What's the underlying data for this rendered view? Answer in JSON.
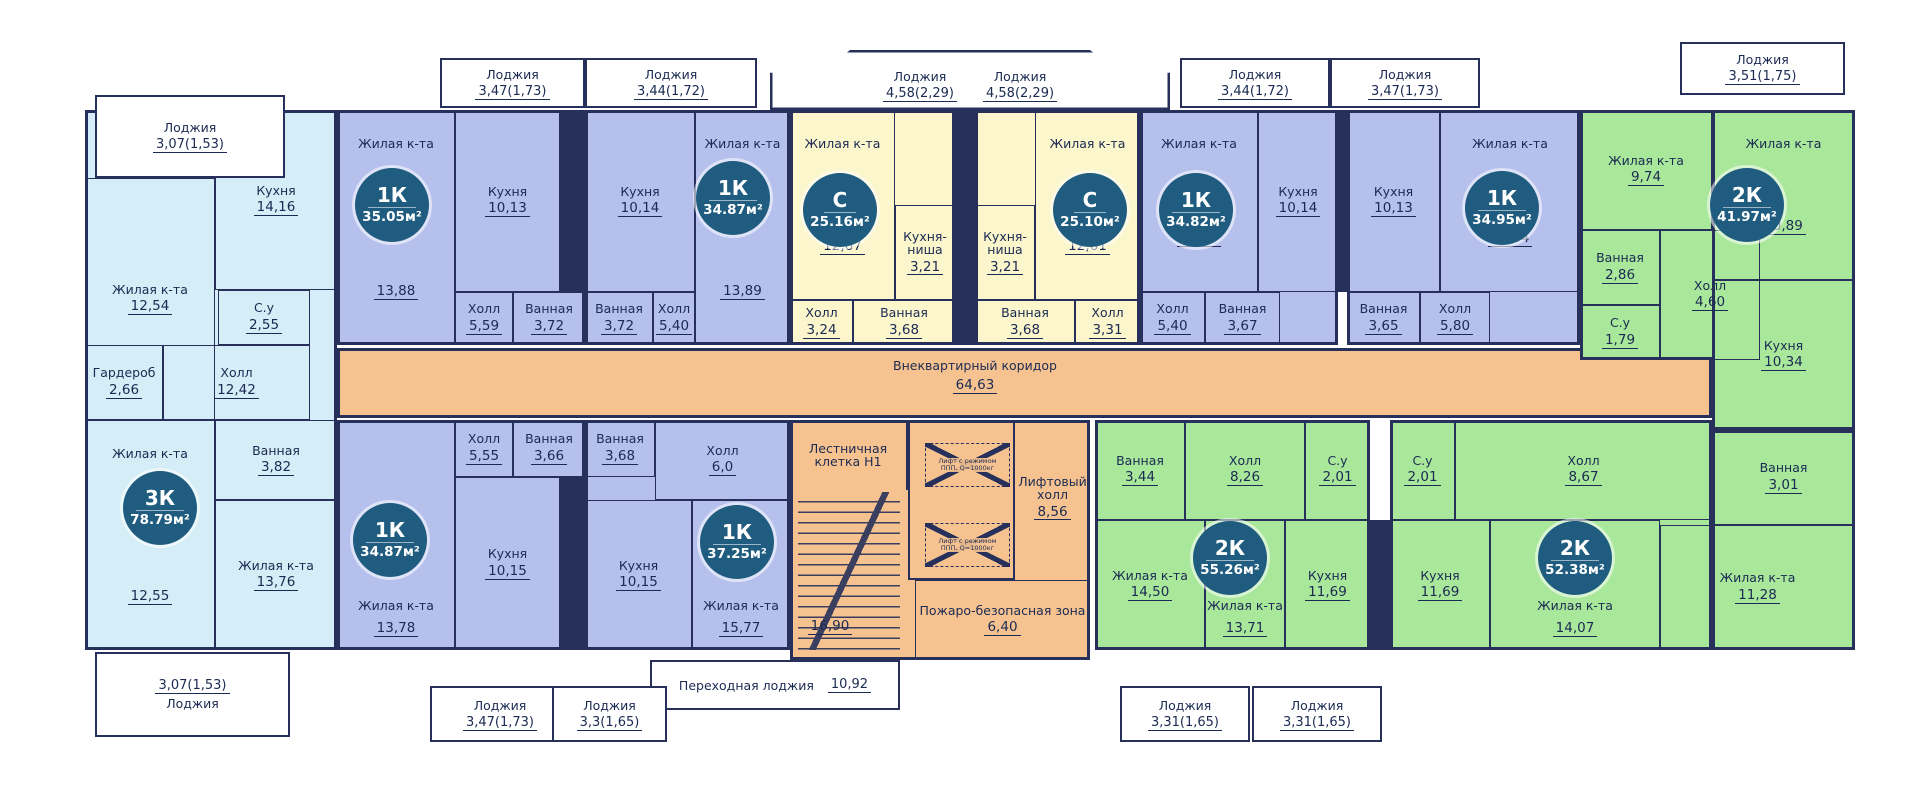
{
  "colors": {
    "apartment_3k": "#d5edf6",
    "apartment_1k": "#b5c0ed",
    "apartment_studio": "#fbf6cc",
    "apartment_2k": "#a9e79b",
    "common_area": "#f6c390",
    "badge": "#1f5c7f",
    "line": "#26305a"
  },
  "corridor": {
    "name": "Внеквартирный коридор",
    "area": "64,63"
  },
  "core": {
    "stairs_name": "Лестничная клетка Н1",
    "stairs_area": "16,90",
    "lift_hall_name": "Лифтовый холл",
    "lift_hall_area": "8,56",
    "lift_cabin_line1": "Лифт с режимом",
    "lift_cabin_line2": "ППП, Q=1000кг",
    "fire_zone_name": "Пожаро-безопасная зона",
    "fire_zone_area": "6,40",
    "transfer_loggia_name": "Переходная лоджия",
    "transfer_loggia_area": "10,92"
  },
  "apartments": [
    {
      "badge_type": "3К",
      "badge_area": "78.79м²",
      "rooms": [
        {
          "name": "Жилая к-та",
          "area": "12,54"
        },
        {
          "name": "Кухня",
          "area": "14,16"
        },
        {
          "name": "С.у",
          "area": "2,55"
        },
        {
          "name": "Гардероб",
          "area": "2,66"
        },
        {
          "name": "Холл",
          "area": "12,42"
        },
        {
          "name": "Ванная",
          "area": "3,82"
        },
        {
          "name": "Жилая к-та",
          "area": "12,55"
        },
        {
          "name": "Жилая к-та",
          "area": "13,76"
        }
      ],
      "loggias": [
        {
          "name": "Лоджия",
          "area": "3,07(1,53)"
        },
        {
          "name": "Лоджия",
          "area": "3,07(1,53)"
        }
      ]
    },
    {
      "badge_type": "1К",
      "badge_area": "35.05м²",
      "rooms": [
        {
          "name": "Жилая к-та",
          "area": "13,88"
        },
        {
          "name": "Кухня",
          "area": "10,13"
        },
        {
          "name": "Холл",
          "area": "5,59"
        },
        {
          "name": "Ванная",
          "area": "3,72"
        }
      ],
      "loggias": [
        {
          "name": "Лоджия",
          "area": "3,47(1,73)"
        }
      ]
    },
    {
      "badge_type": "1К",
      "badge_area": "34.87м²",
      "rooms": [
        {
          "name": "Кухня",
          "area": "10,14"
        },
        {
          "name": "Жилая к-та",
          "area": "13,89"
        },
        {
          "name": "Ванная",
          "area": "3,72"
        },
        {
          "name": "Холл",
          "area": "5,40"
        }
      ],
      "loggias": [
        {
          "name": "Лоджия",
          "area": "3,44(1,72)"
        }
      ]
    },
    {
      "badge_type": "С",
      "badge_area": "25.16м²",
      "rooms": [
        {
          "name": "Жилая к-та",
          "area": "12,67"
        },
        {
          "name": "Кухня-ниша",
          "area": "3,21"
        },
        {
          "name": "Холл",
          "area": "3,24"
        },
        {
          "name": "Ванная",
          "area": "3,68"
        }
      ],
      "loggias": [
        {
          "name": "Лоджия",
          "area": "4,58(2,29)"
        }
      ]
    },
    {
      "badge_type": "С",
      "badge_area": "25.10м²",
      "rooms": [
        {
          "name": "Кухня-ниша",
          "area": "3,21"
        },
        {
          "name": "Жилая к-та",
          "area": "12,61"
        },
        {
          "name": "Ванная",
          "area": "3,68"
        },
        {
          "name": "Холл",
          "area": "3,31"
        }
      ],
      "loggias": [
        {
          "name": "Лоджия",
          "area": "4,58(2,29)"
        }
      ]
    },
    {
      "badge_type": "1К",
      "badge_area": "34.82м²",
      "rooms": [
        {
          "name": "Жилая к-та",
          "area": "13,89"
        },
        {
          "name": "Кухня",
          "area": "10,14"
        },
        {
          "name": "Холл",
          "area": "5,40"
        },
        {
          "name": "Ванная",
          "area": "3,67"
        }
      ],
      "loggias": [
        {
          "name": "Лоджия",
          "area": "3,44(1,72)"
        }
      ]
    },
    {
      "badge_type": "1К",
      "badge_area": "34.95м²",
      "rooms": [
        {
          "name": "Кухня",
          "area": "10,13"
        },
        {
          "name": "Жилая к-та",
          "area": "13,64"
        },
        {
          "name": "Ванная",
          "area": "3,65"
        },
        {
          "name": "Холл",
          "area": "5,80"
        }
      ],
      "loggias": [
        {
          "name": "Лоджия",
          "area": "3,47(1,73)"
        }
      ]
    },
    {
      "badge_type": "2К",
      "badge_area": "41.97м²",
      "rooms": [
        {
          "name": "Жилая к-та",
          "area": "9,74"
        },
        {
          "name": "Ванная",
          "area": "2,86"
        },
        {
          "name": "Холл",
          "area": "4,60"
        },
        {
          "name": "С.у",
          "area": "1,79"
        },
        {
          "name": "Жилая к-та",
          "area": "10,89"
        },
        {
          "name": "Кухня",
          "area": "10,34"
        }
      ],
      "loggias": [
        {
          "name": "Лоджия",
          "area": "3,51(1,75)"
        }
      ]
    },
    {
      "badge_type": "1К",
      "badge_area": "34.87м²",
      "rooms": [
        {
          "name": "Жилая к-та",
          "area": "13,78"
        },
        {
          "name": "Холл",
          "area": "5,55"
        },
        {
          "name": "Ванная",
          "area": "3,66"
        },
        {
          "name": "Кухня",
          "area": "10,15"
        }
      ],
      "loggias": [
        {
          "name": "Лоджия",
          "area": "3,47(1,73)"
        }
      ]
    },
    {
      "badge_type": "1К",
      "badge_area": "37.25м²",
      "rooms": [
        {
          "name": "Ванная",
          "area": "3,68"
        },
        {
          "name": "Холл",
          "area": "6,0"
        },
        {
          "name": "Кухня",
          "area": "10,15"
        },
        {
          "name": "Жилая к-та",
          "area": "15,77"
        }
      ],
      "loggias": [
        {
          "name": "Лоджия",
          "area": "3,3(1,65)"
        }
      ]
    },
    {
      "badge_type": "2К",
      "badge_area": "55.26м²",
      "rooms": [
        {
          "name": "Ванная",
          "area": "3,44"
        },
        {
          "name": "Холл",
          "area": "8,26"
        },
        {
          "name": "С.у",
          "area": "2,01"
        },
        {
          "name": "Жилая к-та",
          "area": "14,50"
        },
        {
          "name": "Жилая к-та",
          "area": "13,71"
        },
        {
          "name": "Кухня",
          "area": "11,69"
        }
      ],
      "loggias": [
        {
          "name": "Лоджия",
          "area": "3,31(1,65)"
        }
      ]
    },
    {
      "badge_type": "2К",
      "badge_area": "52.38м²",
      "rooms": [
        {
          "name": "С.у",
          "area": "2,01"
        },
        {
          "name": "Холл",
          "area": "8,67"
        },
        {
          "name": "Ванная",
          "area": "3,01"
        },
        {
          "name": "Кухня",
          "area": "11,69"
        },
        {
          "name": "Жилая к-та",
          "area": "14,07"
        },
        {
          "name": "Жилая к-та",
          "area": "11,28"
        }
      ],
      "loggias": [
        {
          "name": "Лоджия",
          "area": "3,31(1,65)"
        }
      ]
    }
  ]
}
